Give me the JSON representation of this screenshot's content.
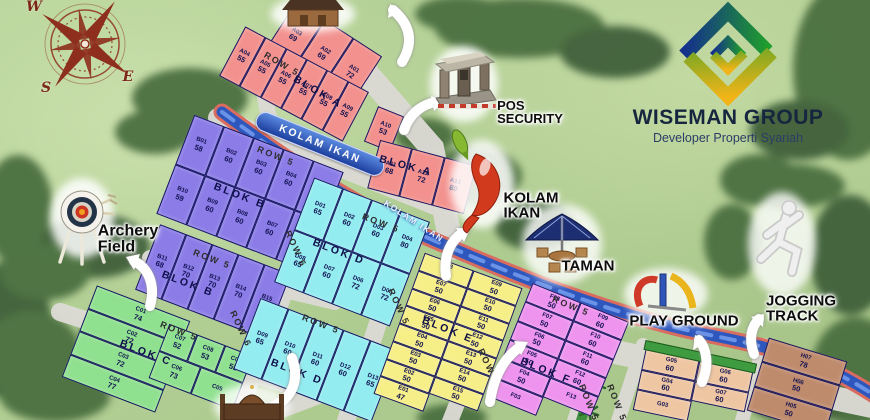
{
  "branding": {
    "company": "WISEMAN GROUP",
    "tagline": "Developer Properti Syariah"
  },
  "compass": {
    "points": [
      {
        "l": "W",
        "x": 34,
        "y": 7
      },
      {
        "l": "S",
        "x": 46,
        "y": 88
      },
      {
        "l": "E",
        "x": 128,
        "y": 77
      }
    ]
  },
  "blocks": [
    {
      "id": "a-top",
      "cls": "b-atop",
      "color": "#f2918d",
      "rows": [
        [
          [
            "A03",
            "69"
          ],
          [
            "A02",
            "69"
          ],
          [
            "A01",
            "72"
          ]
        ]
      ]
    },
    {
      "id": "a-mid",
      "cls": "b-amid",
      "color": "#f2918d",
      "rows": [
        [
          [
            "A04",
            "55"
          ],
          [
            "A05",
            "55"
          ],
          [
            "A06",
            "55"
          ],
          [
            "A07",
            "55"
          ],
          [
            "A08",
            "55"
          ],
          [
            "A09",
            "55"
          ]
        ]
      ]
    },
    {
      "id": "a-10",
      "cls": "b-a10",
      "color": "#f2918d",
      "rows": [
        [
          [
            "A10",
            "53"
          ]
        ]
      ]
    },
    {
      "id": "a-right",
      "cls": "b-aright",
      "color": "#f2918d",
      "rows": [
        [
          [
            "A11",
            "68"
          ],
          [
            "A12",
            "72"
          ],
          [
            "A13",
            "80"
          ]
        ]
      ]
    },
    {
      "id": "b-main",
      "cls": "b-bmain",
      "color": "#8b7ce7",
      "rows": [
        [
          [
            "B01",
            "58"
          ],
          [
            "B02",
            "60"
          ],
          [
            "B03",
            "60"
          ],
          [
            "B04",
            "60"
          ],
          [
            "B05",
            "66"
          ]
        ],
        [
          [
            "B10",
            "59"
          ],
          [
            "B09",
            "60"
          ],
          [
            "B08",
            "60"
          ],
          [
            "B07",
            "60"
          ],
          [
            "B06",
            "66"
          ]
        ]
      ]
    },
    {
      "id": "b-lower",
      "cls": "b-blow",
      "color": "#8b7ce7",
      "rows": [
        [
          [
            "B11",
            "68"
          ],
          [
            "B12",
            "70"
          ],
          [
            "B13",
            "70"
          ],
          [
            "B14",
            "70"
          ],
          [
            "B15",
            "87"
          ]
        ]
      ]
    },
    {
      "id": "c-col",
      "cls": "b-ccol",
      "color": "#8fe08f",
      "rows": [
        [
          [
            "C01",
            "74"
          ]
        ],
        [
          [
            "C02",
            "72"
          ]
        ],
        [
          [
            "C03",
            "72"
          ]
        ],
        [
          [
            "C04",
            "77"
          ]
        ]
      ]
    },
    {
      "id": "c-sub",
      "cls": "b-csub",
      "color": "#8fe08f",
      "rows": [
        [
          [
            "C07",
            "52"
          ],
          [
            "C08",
            "53"
          ],
          [
            "C09",
            "55"
          ]
        ],
        [
          [
            "C06",
            "73"
          ],
          [
            "C05",
            ""
          ]
        ]
      ]
    },
    {
      "id": "d-main",
      "cls": "b-dmain",
      "color": "#93ecf0",
      "rows": [
        [
          [
            "D01",
            "65"
          ],
          [
            "D02",
            "60"
          ],
          [
            "D03",
            "60"
          ],
          [
            "D04",
            "80"
          ]
        ],
        [
          [
            "D08",
            "65"
          ],
          [
            "D07",
            "60"
          ],
          [
            "D06",
            "72"
          ],
          [
            "D05",
            "72"
          ]
        ]
      ]
    },
    {
      "id": "d-lower",
      "cls": "b-dlow",
      "color": "#93ecf0",
      "rows": [
        [
          [
            "D09",
            "65"
          ],
          [
            "D10",
            "60"
          ],
          [
            "D11",
            "60"
          ],
          [
            "D12",
            "60"
          ],
          [
            "D13",
            "65"
          ]
        ]
      ]
    },
    {
      "id": "e",
      "cls": "b-e",
      "color": "#f6ee86",
      "rows": [
        [
          [
            "E08",
            "50"
          ],
          [
            "E09",
            "50"
          ]
        ],
        [
          [
            "E07",
            "50"
          ],
          [
            "E10",
            "50"
          ]
        ],
        [
          [
            "E06",
            "50"
          ],
          [
            "E11",
            "50"
          ]
        ],
        [
          [
            "E05",
            "50"
          ],
          [
            "E12",
            "50"
          ]
        ],
        [
          [
            "E04",
            "50"
          ],
          [
            "E13",
            "50"
          ]
        ],
        [
          [
            "E03",
            "50"
          ],
          [
            "E14",
            "50"
          ]
        ],
        [
          [
            "E02",
            "50"
          ],
          [
            "E15",
            "50"
          ]
        ],
        [
          [
            "E01",
            "47"
          ],
          null
        ]
      ]
    },
    {
      "id": "f",
      "cls": "b-f",
      "color": "#ee93ee",
      "rows": [
        [
          [
            "F08",
            "50"
          ],
          [
            "F09",
            "60"
          ]
        ],
        [
          [
            "F07",
            "50"
          ],
          [
            "F10",
            "60"
          ]
        ],
        [
          [
            "F06",
            "50"
          ],
          [
            "F11",
            "60"
          ]
        ],
        [
          [
            "F05",
            "50"
          ],
          [
            "F12",
            "60"
          ]
        ],
        [
          [
            "F04",
            "50"
          ],
          [
            "F13",
            ""
          ]
        ],
        [
          [
            "F03",
            ""
          ],
          null
        ]
      ]
    },
    {
      "id": "g",
      "cls": "b-g",
      "color": "#eec6a2",
      "rows": [
        [
          [
            "G05",
            "60"
          ],
          [
            "G06",
            "60"
          ]
        ],
        [
          [
            "G04",
            "60"
          ],
          [
            "G07",
            "60"
          ]
        ],
        [
          [
            "G03",
            ""
          ],
          null
        ]
      ]
    },
    {
      "id": "h",
      "cls": "b-h",
      "color": "#bf8b6d",
      "rows": [
        [
          [
            "H07",
            "78"
          ]
        ],
        [
          [
            "H06",
            "50"
          ]
        ],
        [
          [
            "H05",
            "50"
          ]
        ]
      ]
    }
  ],
  "map_labels": [
    {
      "t": "ROW 5",
      "k": "road",
      "x": 282,
      "y": 64,
      "r": 30
    },
    {
      "t": "BLOK A",
      "k": "blok",
      "x": 318,
      "y": 92,
      "r": 30
    },
    {
      "t": "KOLAM IKAN",
      "k": "river",
      "x": 320,
      "y": 144,
      "r": 22
    },
    {
      "t": "ROW 5",
      "k": "road",
      "x": 276,
      "y": 156,
      "r": 22
    },
    {
      "t": "BLOK A",
      "k": "blok",
      "x": 406,
      "y": 166,
      "r": 15
    },
    {
      "t": "KOLAM IKAN",
      "k": "river2",
      "x": 414,
      "y": 221,
      "r": 33
    },
    {
      "t": "BLOK B",
      "k": "blok",
      "x": 240,
      "y": 196,
      "r": 21
    },
    {
      "t": "ROW 6",
      "k": "road",
      "x": 296,
      "y": 249,
      "r": 65
    },
    {
      "t": "ROW 5",
      "k": "road",
      "x": 212,
      "y": 259,
      "r": 21
    },
    {
      "t": "BLOK B",
      "k": "blok",
      "x": 188,
      "y": 284,
      "r": 21
    },
    {
      "t": "ROW 5",
      "k": "road",
      "x": 179,
      "y": 331,
      "r": 21
    },
    {
      "t": "ROW 6",
      "k": "road",
      "x": 241,
      "y": 329,
      "r": 65
    },
    {
      "t": "ROW 5",
      "k": "road",
      "x": 381,
      "y": 223,
      "r": 21
    },
    {
      "t": "BLOK D",
      "k": "blok",
      "x": 339,
      "y": 252,
      "r": 21
    },
    {
      "t": "ROW 5",
      "k": "road",
      "x": 399,
      "y": 307,
      "r": 65
    },
    {
      "t": "ROW 5",
      "k": "road",
      "x": 321,
      "y": 324,
      "r": 21
    },
    {
      "t": "BLOK D",
      "k": "blok",
      "x": 297,
      "y": 372,
      "r": 21
    },
    {
      "t": "BLOK C",
      "k": "blok",
      "x": 146,
      "y": 353,
      "r": 21
    },
    {
      "t": "ROW 5",
      "k": "road",
      "x": 489,
      "y": 367,
      "r": 65
    },
    {
      "t": "BLOK E",
      "k": "blok",
      "x": 448,
      "y": 330,
      "r": 22
    },
    {
      "t": "ROW 5",
      "k": "road",
      "x": 571,
      "y": 306,
      "r": 22
    },
    {
      "t": "BLOK F",
      "k": "blok",
      "x": 546,
      "y": 371,
      "r": 22
    },
    {
      "t": "ROW 5",
      "k": "road",
      "x": 589,
      "y": 403,
      "r": 68
    },
    {
      "t": "ROW 5",
      "k": "road",
      "x": 617,
      "y": 403,
      "r": 68
    }
  ],
  "amenities": [
    {
      "id": "archery-field",
      "lines": [
        "Archery",
        "Field"
      ],
      "x": 128,
      "y": 240,
      "s": 16,
      "a": "left"
    },
    {
      "id": "pos-security",
      "lines": [
        "POS",
        "SECURITY"
      ],
      "x": 530,
      "y": 112,
      "s": 13,
      "a": "left"
    },
    {
      "id": "kolam-ikan",
      "lines": [
        "KOLAM",
        "IKAN"
      ],
      "x": 531,
      "y": 206,
      "s": 15,
      "a": "left"
    },
    {
      "id": "taman",
      "lines": [
        "TAMAN"
      ],
      "x": 588,
      "y": 266,
      "s": 15,
      "a": "center"
    },
    {
      "id": "play-ground",
      "lines": [
        "PLAY GROUND"
      ],
      "x": 684,
      "y": 321,
      "s": 15,
      "a": "center"
    },
    {
      "id": "jogging-track",
      "lines": [
        "JOGGING",
        "TRACK"
      ],
      "x": 801,
      "y": 309,
      "s": 15,
      "a": "left"
    }
  ],
  "palette": {
    "river": "#2e57bd",
    "road": "#dbdad4",
    "grass": "#aeca8e",
    "trees": "#4c7040",
    "logo_blue": "#14308c",
    "logo_green": "#1f9e2c",
    "logo_yellow": "#f0b418"
  }
}
